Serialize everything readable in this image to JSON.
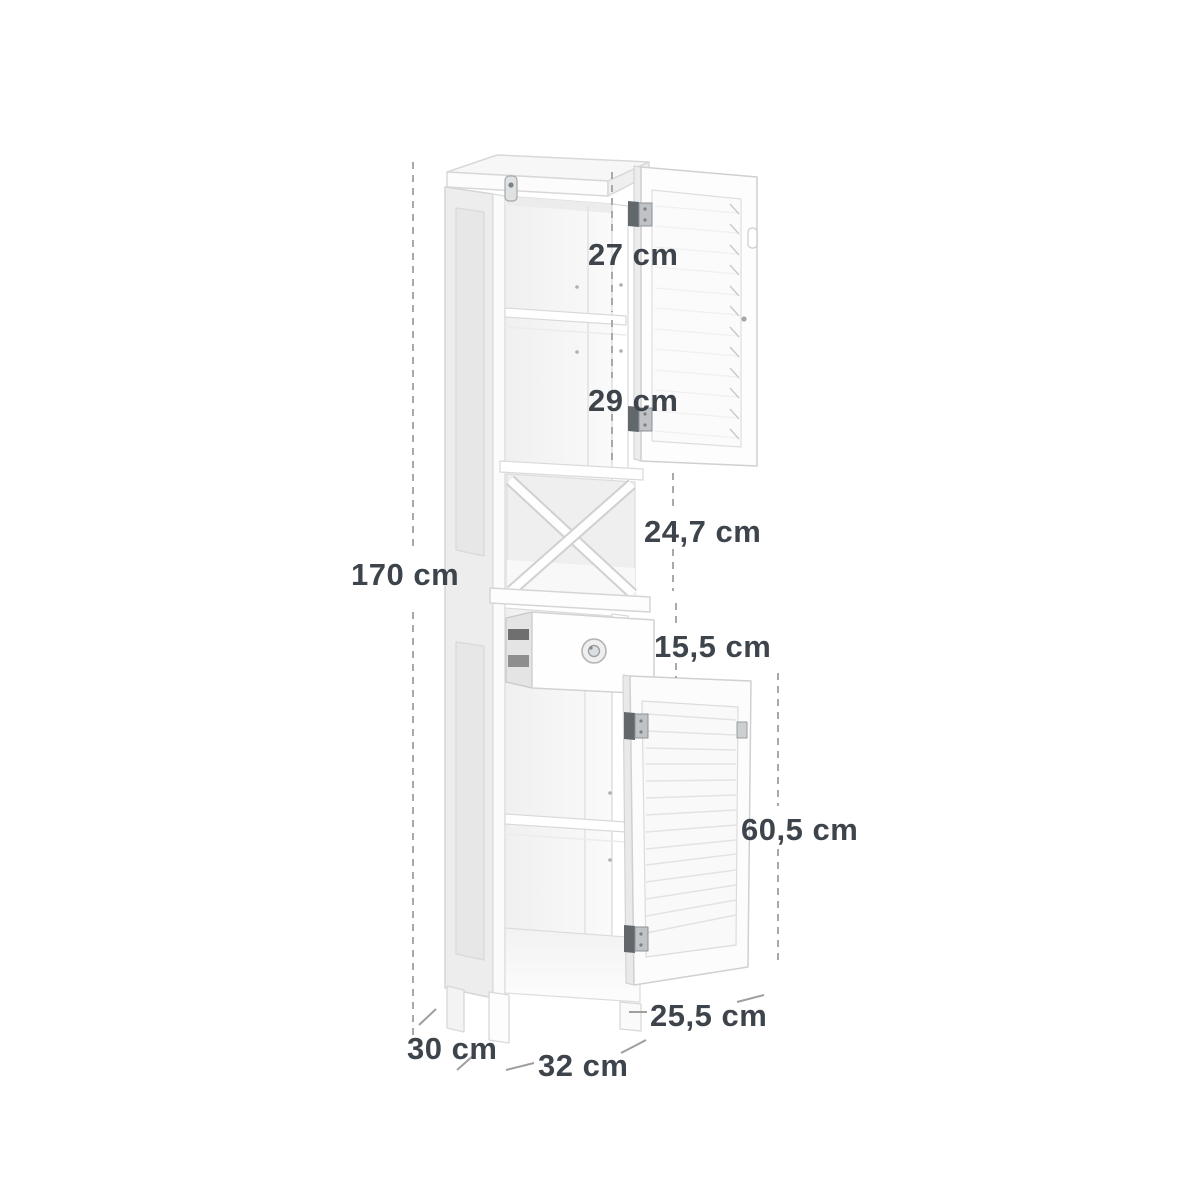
{
  "diagram": {
    "title": "Tall bathroom storage cabinet dimension diagram",
    "unit": "cm",
    "labels": {
      "total_height": "170 cm",
      "top_compartment": "27 cm",
      "second_compartment": "29 cm",
      "x_compartment": "24,7 cm",
      "drawer": "15,5 cm",
      "bottom_door": "60,5 cm",
      "bottom_opening": "25,5 cm",
      "depth": "30 cm",
      "width": "32 cm"
    },
    "colors": {
      "label_text": "#3e444b",
      "dimension_line": "#a9a9a9",
      "tick_line": "#9e9e9e",
      "cabinet_outline": "#d2d2d2",
      "cabinet_fill": "#fdfdfd",
      "interior_fill": "#f3f3f3",
      "hinge_dark": "#62676c",
      "hinge_light": "#c0c3c6"
    }
  }
}
